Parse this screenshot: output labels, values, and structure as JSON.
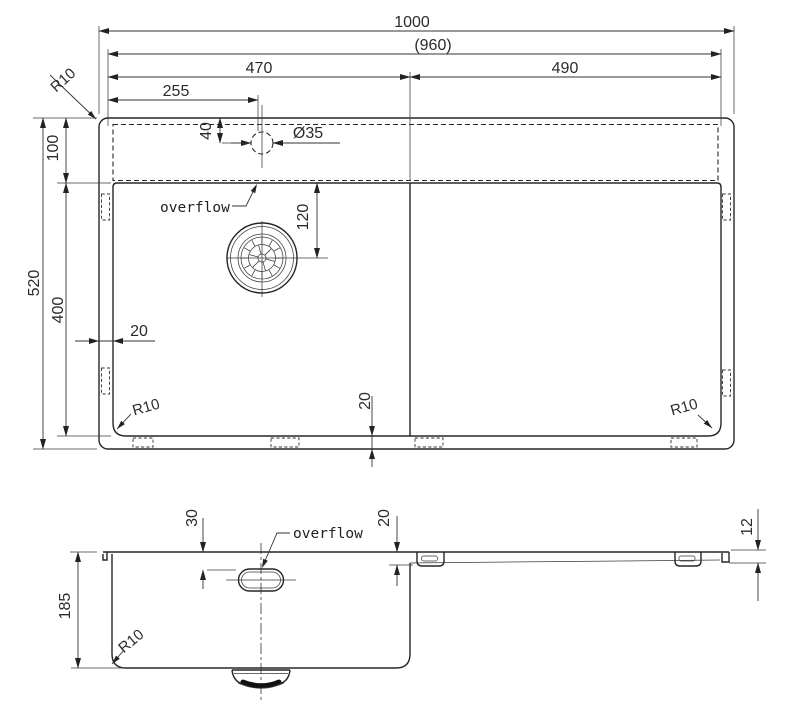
{
  "drawing_title": "undermount sink dimension drawing",
  "colors": {
    "line": "#262626",
    "background": "#ffffff"
  },
  "top_view": {
    "dim_overall_width": "1000",
    "dim_inner_width": "(960)",
    "dim_bowl_width": "470",
    "dim_board_width": "490",
    "dim_faucet_x": "255",
    "dim_deck_depth": "100",
    "dim_overall_depth": "520",
    "dim_bowl_depth": "400",
    "dim_side_margin": "20",
    "dim_bottom_margin": "20",
    "dim_faucet_y": "40",
    "dim_faucet_dia": "Ø35",
    "dim_drain_y": "120",
    "label_overflow": "overflow",
    "label_r_topleft": "R10",
    "label_r_bottomleft": "R10",
    "label_r_bottomright": "R10"
  },
  "front_view": {
    "dim_depth": "185",
    "dim_overflow_drop": "30",
    "dim_step": "20",
    "dim_edge_thickness": "12",
    "label_overflow": "overflow",
    "label_r": "R10"
  }
}
